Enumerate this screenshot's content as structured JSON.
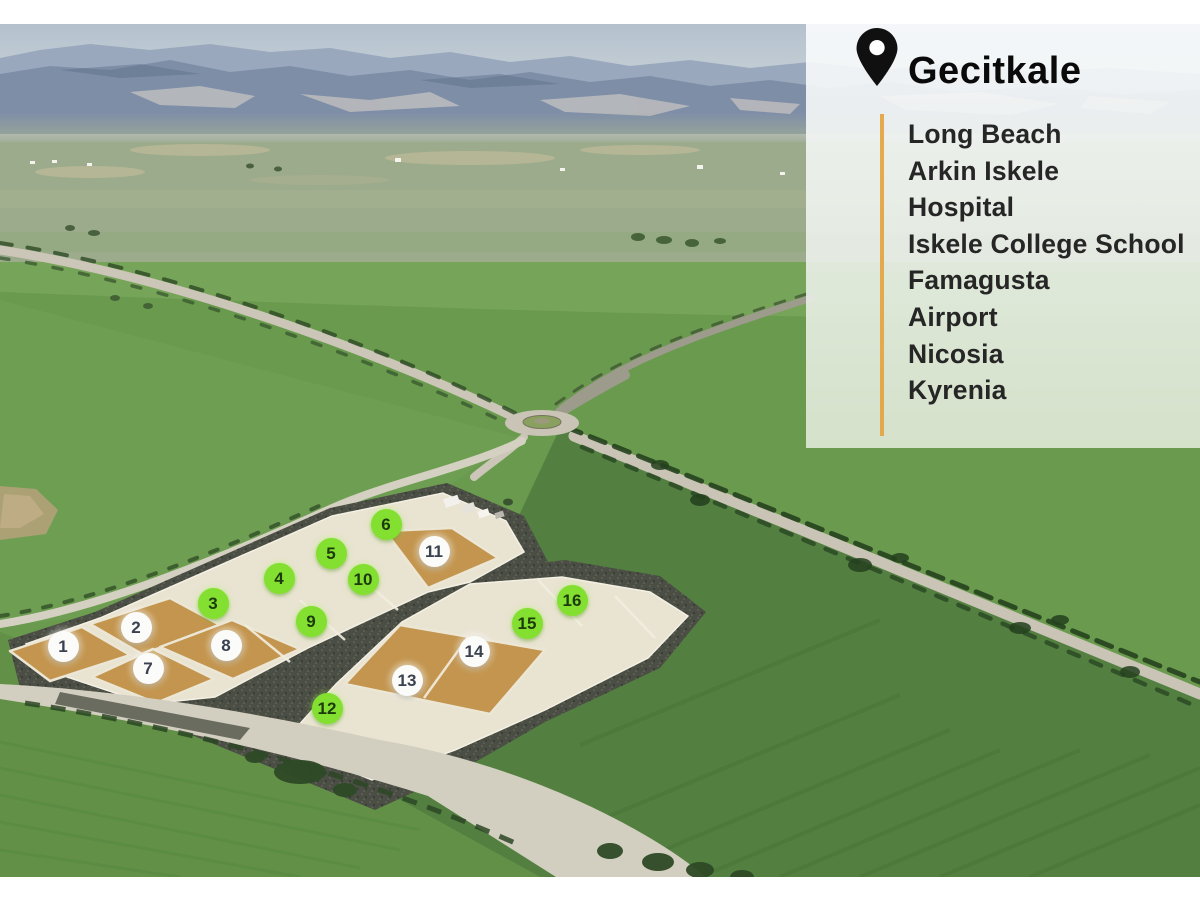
{
  "panel": {
    "title": "Gecitkale",
    "places": [
      "Long Beach",
      "Arkin Iskele",
      "Hospital",
      "Iskele College School",
      "Famagusta",
      "Airport",
      "Nicosia",
      "Kyrenia"
    ],
    "accent_color": "#e3a23d",
    "text_color": "#262626"
  },
  "plot_markers": {
    "green_color": "#83e030",
    "white_color": "#fbfbf9",
    "items": [
      {
        "n": "1",
        "x": 63,
        "y": 646,
        "style": "white"
      },
      {
        "n": "2",
        "x": 136,
        "y": 627,
        "style": "white"
      },
      {
        "n": "3",
        "x": 213,
        "y": 603,
        "style": "green"
      },
      {
        "n": "4",
        "x": 279,
        "y": 578,
        "style": "green"
      },
      {
        "n": "5",
        "x": 331,
        "y": 553,
        "style": "green"
      },
      {
        "n": "6",
        "x": 386,
        "y": 524,
        "style": "green"
      },
      {
        "n": "7",
        "x": 148,
        "y": 668,
        "style": "white"
      },
      {
        "n": "8",
        "x": 226,
        "y": 645,
        "style": "white"
      },
      {
        "n": "9",
        "x": 311,
        "y": 621,
        "style": "green"
      },
      {
        "n": "10",
        "x": 363,
        "y": 579,
        "style": "green"
      },
      {
        "n": "11",
        "x": 434,
        "y": 551,
        "style": "white"
      },
      {
        "n": "12",
        "x": 327,
        "y": 708,
        "style": "green"
      },
      {
        "n": "13",
        "x": 407,
        "y": 680,
        "style": "white"
      },
      {
        "n": "14",
        "x": 474,
        "y": 651,
        "style": "white"
      },
      {
        "n": "15",
        "x": 527,
        "y": 623,
        "style": "green"
      },
      {
        "n": "16",
        "x": 572,
        "y": 600,
        "style": "green"
      }
    ]
  },
  "photo_palette": {
    "field_green": "#699a4d",
    "parcel_tan": "#c3954e",
    "platform_cream": "#e9e3d2",
    "gravel_dark": "#4b4e44",
    "road_light": "#cbc6b7",
    "sky_blue": "#b4c1cd"
  }
}
